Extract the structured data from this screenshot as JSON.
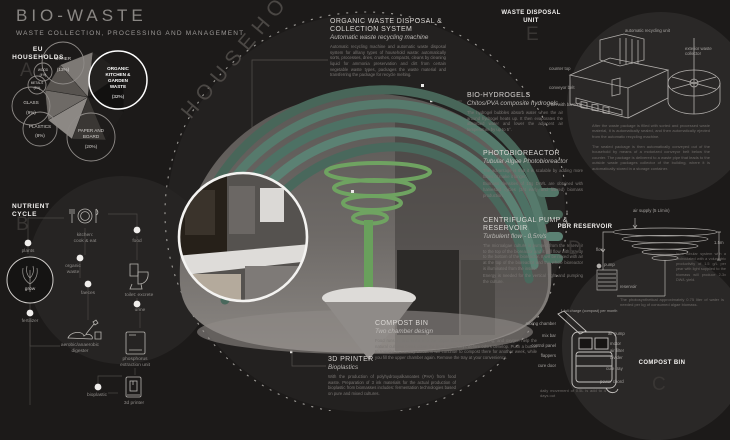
{
  "header": {
    "title": "BIO-WASTE",
    "subtitle": "WASTE COLLECTION, PROCESSING AND MANAGEMENT"
  },
  "eu": {
    "label_line1": "EU",
    "label_line2": "HOUSEHOLDS",
    "letter": "A"
  },
  "chart_data": {
    "type": "pie",
    "title": "EU households waste composition",
    "categories": [
      "ORGANIC KITCHEN & GARDEN WASTE",
      "PAPER AND BOARD",
      "OTHER",
      "GLASS",
      "PLASTICS",
      "WOOD",
      "METALS"
    ],
    "values": [
      32,
      20,
      13,
      9,
      8,
      4,
      3
    ],
    "unit": "%",
    "legend_position": "around-bubbles",
    "grid": false
  },
  "pie_labels": {
    "other1": "OTHER",
    "other2": "(13%)",
    "wood1": "WOOD",
    "wood2": "(4%)",
    "metal1": "METALS",
    "metal2": "(3%)",
    "glass1": "GLASS",
    "glass2": "(9%)",
    "plastics1": "PLASTICS",
    "plastics2": "(8%)",
    "paper1": "PAPER AND",
    "paper2": "BOARD",
    "paper3": "(20%)",
    "org1": "ORGANIC",
    "org2": "KITCHEN &",
    "org3": "GARDEN",
    "org4": "WASTE",
    "org5": "(32%)"
  },
  "arc_title": "HOUSEHOLD UNITS",
  "nutrient": {
    "label_line1": "NUTRIENT",
    "label_line2": "CYCLE",
    "letter": "B",
    "plants": "plants",
    "kitchen1": "kitchen:",
    "kitchen2": "cook & eat",
    "food": "food",
    "organic1": "organic",
    "organic2": "waste",
    "faeces": "faeces",
    "toilet": "toilet: excrete",
    "urine": "urine",
    "grow": "grow",
    "fertilizer": "fertilizer",
    "digester1": "aerobic/anaerobic",
    "digester2": "digester",
    "phos1": "phosphorus",
    "phos2": "extraction unit",
    "bioplastic": "bioplastic",
    "printer": "3d printer"
  },
  "annotations": {
    "organic_system": {
      "title": "ORGANIC WASTE DISPOSAL & COLLECTION SYSTEM",
      "subtitle": "Automatic waste recycling machine",
      "body": "Automatic recycling machine and automatic waste disposal system for all/any types of household waste: automatically sorts, processes, dries, crushes, compacts, cleans by cleaning liquid for ammonia preservation and dirt from certain vegetable waste types, packages the waste material and transferring the package for recycle melting."
    },
    "bio_hydrogels": {
      "title": "BIO-HYDROGELS",
      "subtitle": "Chitos/PVA composite hydrogels",
      "body": "The hydrogel bubbles absorb water when the air around hydrogel heats up. It then evaporates the absorbed water and lower the adjacent air temperature by up to 5°."
    },
    "photobioreactor": {
      "title": "PHOTOBIOREACTOR",
      "subtitle": "Tubular Algae Photobioreactor",
      "body": "The advantage is that it is scalable by adding more tubes or make it longer.",
      "body2": "Biomass densities of 10g DW/L are obtained with harvested cycles (3/4 early and filtered) biomass production."
    },
    "pump_reservoir": {
      "title": "CENTRIFUGAL PUMP & RESERVOIR",
      "subtitle": "Turbulent flow - 0.5m/s",
      "body": "The microalgae culture is pumped from the reservoir to the top of the bioreactor and it will flow with gravity to the bottom of the bioreactor. It will be mixed with air at the top of the bioreactor and the whole bioreactor is illuminated from the inside.",
      "body2": "Energy is needed for the vertical flight and pumping the culture."
    },
    "compost_bin": {
      "title": "COMPOST BIN",
      "subtitle": "Two chamber design",
      "body": "Food runs in and sinks into the upper chamber. Heat, mixing, and oxygen help the natural cultures break down the food within days before odors develop. Push a button to transfer to the tray below. It will continue to compost there for another week, while you fill the upper chamber again. Remove the tray at your convenience."
    },
    "printer_3d": {
      "title": "3D PRINTER",
      "subtitle": "Bioplastics",
      "body": "With the production of polyhydroxyalkanoates (PHA) from food waste. Preparation of 3 ink materials for the actual production of bioplastic from biomasses includes: fermentation technologies based on pure and mixed cultures."
    }
  },
  "wdu": {
    "label": "WASTE DISPOSAL UNIT",
    "letter": "E",
    "lbl_unit": "automatic recycling unit",
    "lbl_collector": "exterior waste collector",
    "lbl_counter": "counter top",
    "lbl_conveyor": "conveyor belt",
    "lbl_bin": "bin with barcode",
    "body1": "After the waste package is filled with sorted and processed waste material, it is automatically sealed, and then automatically ejected from the automatic recycling machine.",
    "body2": "The sealed package is then automatically conveyed out of the household by means of a motorized conveyor belt below the counter. The package is delivered to a waste pipe that leads to the outside waste packages collector of the building, where it is automatically stored in a storage container."
  },
  "pbr": {
    "label": "PBR RESERVOIR",
    "letter": "D",
    "lbl_air": "air supply (5 L/min)",
    "lbl_flow": "flow",
    "lbl_pump": "pump",
    "lbl_reservoir": "reservoir",
    "lbl_dim": "1.5m",
    "side_note": "In a tubular system with a recirculated with a volumetric productivity of 1.5 g/L per year with light supplied to the biomass will produce 2-3x DW/L yield.",
    "caption": "The photosynthetical approximately 0.75 liter of water is needed per kg of consumed algae biomass."
  },
  "compost": {
    "label": "COMPOST BIN",
    "letter": "C",
    "lbl_top": "1 full charge (compost) per month",
    "lbl_mixing": "mixing chamber",
    "lbl_mixbar": "mix bar",
    "lbl_control": "control panel",
    "lbl_flappers": "flappers",
    "lbl_curedoor": "cure door",
    "lbl_airpump": "air pump",
    "lbl_motor": "motor",
    "lbl_airfilter": "air filter",
    "lbl_divider": "divider",
    "lbl_curetray": "cure tray",
    "lbl_power": "power chord",
    "caption": "daily movement of 0.5L is add to 4 days out"
  },
  "colors": {
    "background": "#1c1a19",
    "accent_teal": "#55796d",
    "accent_green": "#6fa361",
    "text_light": "#e8e6e3",
    "text_muted": "#7b7774"
  }
}
